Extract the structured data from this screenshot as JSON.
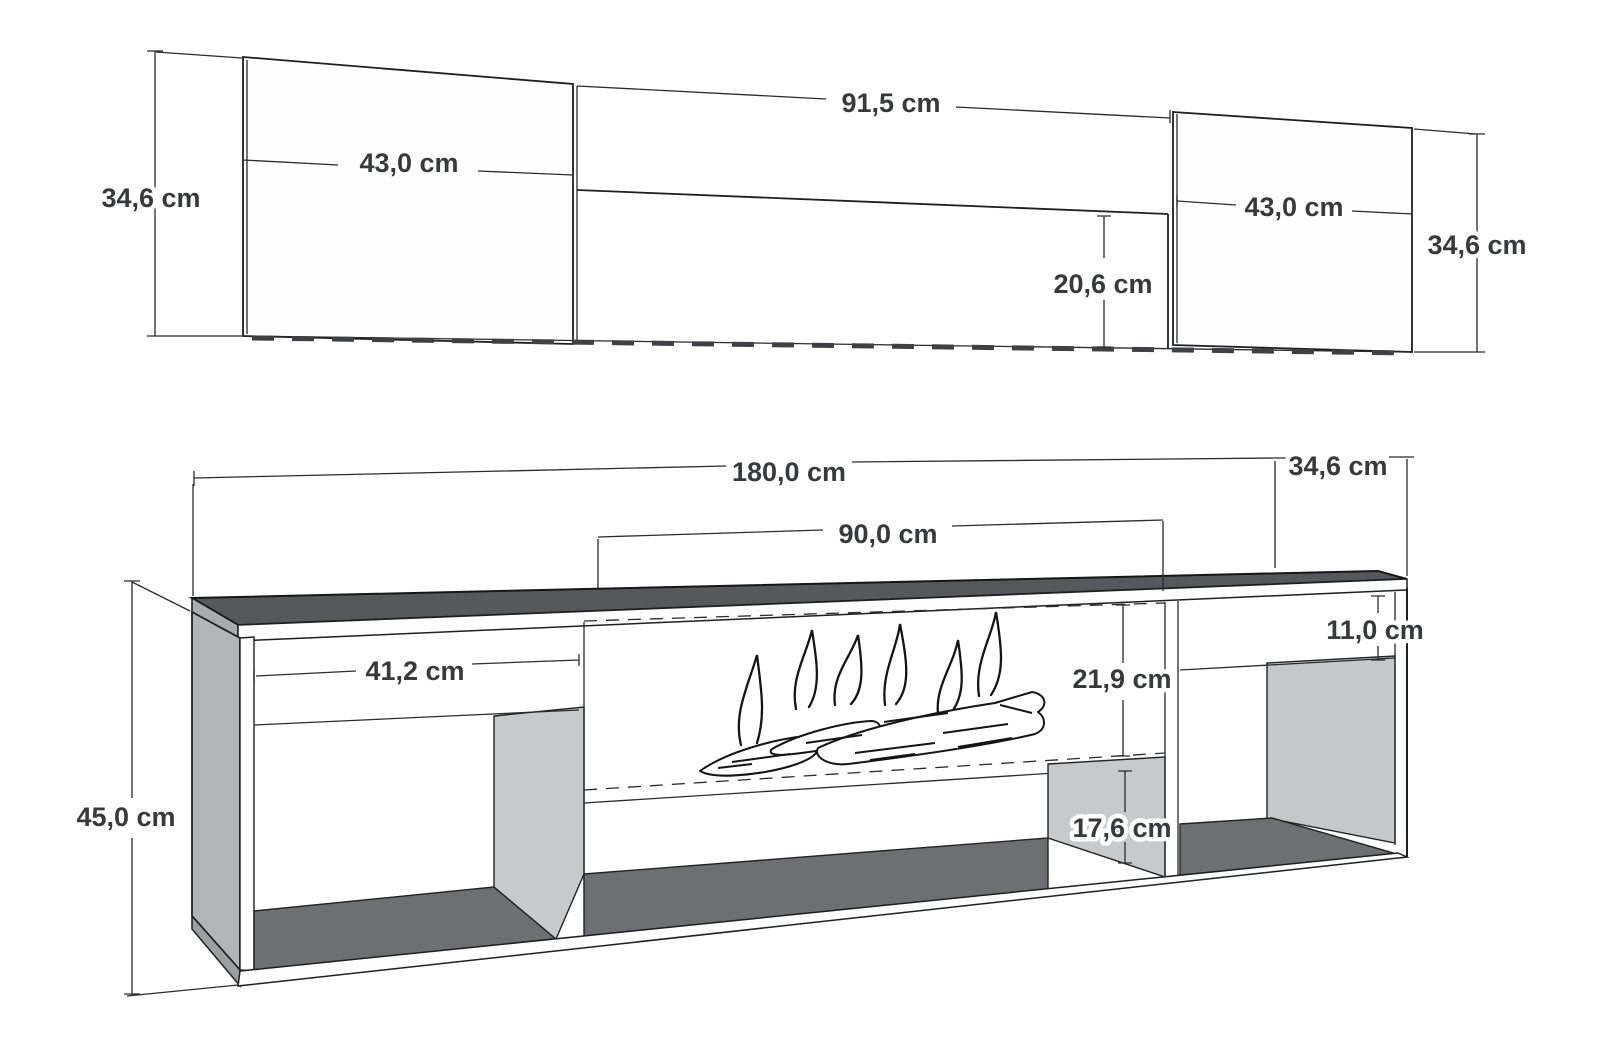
{
  "diagram": {
    "unit": "cm",
    "views": {
      "elevation": {
        "label": "wall unit front elevation",
        "left_panel_height": "34,6 cm",
        "left_panel_width": "43,0 cm",
        "middle_width": "91,5 cm",
        "middle_cabinet_height": "20,6 cm",
        "right_panel_width": "43,0 cm",
        "right_panel_height": "34,6 cm"
      },
      "perspective": {
        "label": "TV stand with fireplace perspective view",
        "total_width": "180,0 cm",
        "top_depth": "34,6 cm",
        "fireplace_width": "90,0 cm",
        "left_compartment_width": "41,2 cm",
        "top_flap_height": "11,0 cm",
        "fireplace_opening_height": "21,9 cm",
        "total_height": "45,0 cm",
        "bottom_compartment_height": "17,6 cm"
      }
    },
    "colors": {
      "top_surface": "#57585c",
      "interior_floor": "#6d6f72",
      "side_panel": "#b2b4b6",
      "divider_wall": "#c7c9cb",
      "edge_wedge": "#9c9ea0",
      "line": "#1e1f21",
      "label": "#38393b"
    }
  }
}
